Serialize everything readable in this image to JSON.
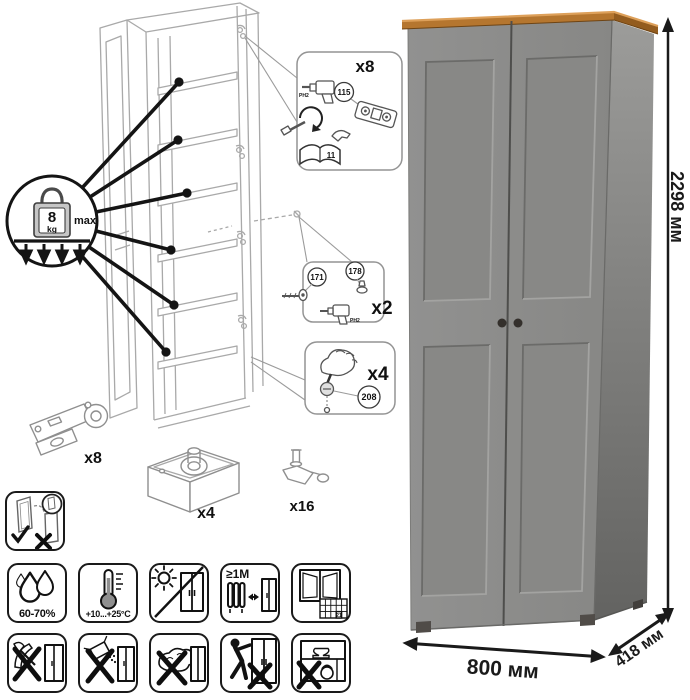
{
  "assembly": {
    "load_limit": {
      "value": "8",
      "unit": "kg",
      "qualifier": "max"
    },
    "hinge_callout": {
      "qty": "x8",
      "screw_part": "115",
      "drill_bit": "PH2",
      "manual_page": "11"
    },
    "fitting_callout": {
      "qty": "x2",
      "screw_part": "171",
      "grommet_part": "178",
      "drill_bit": "PH2"
    },
    "cam_callout": {
      "qty": "x4",
      "part": "208"
    },
    "hardware": {
      "hinge_qty": "x8",
      "cam_lock_qty": "x4",
      "shelf_pin_qty": "x16"
    }
  },
  "care": {
    "humidity": "60-70%",
    "temperature": "+10...+25°C",
    "min_distance": "≥1М",
    "airing_day": "21"
  },
  "dimensions": {
    "height": "2298 мм",
    "width": "800 мм",
    "depth": "418 мм"
  },
  "colors": {
    "door_gray": "#8a8a88",
    "wood_top": "#b5762f"
  }
}
